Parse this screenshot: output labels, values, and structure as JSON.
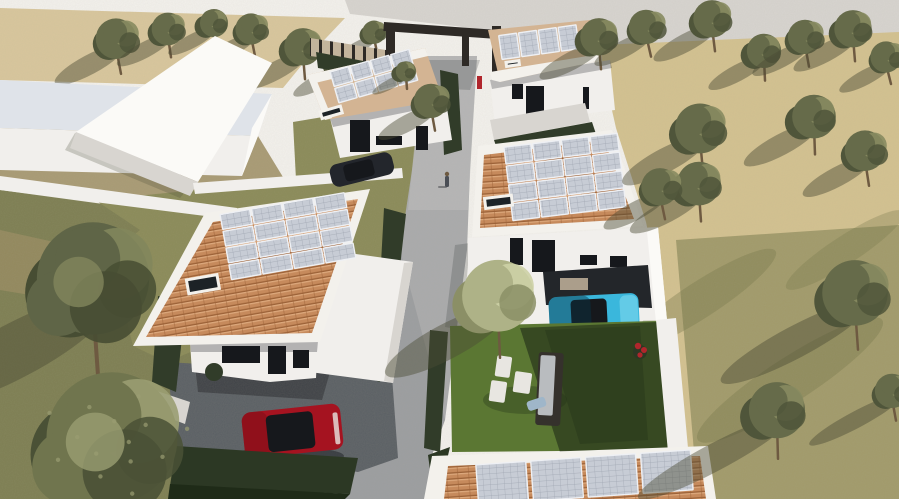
{
  "meta": {
    "description": "Aerial 3D architectural rendering of a residential development: five modern white houses with terracotta roofs and rooftop solar panels, a central grey footpath, an olive-tree orchard on the right, gardens with outdoor furniture, a red car on a driveway and a cyan car under a carport.",
    "render_type": "daylight exterior visualization, top-down oblique view"
  },
  "colors": {
    "sky_top": "#f3f1ed",
    "road_top": "#d7d4d0",
    "tan_ground": "#d8c69c",
    "tan_orchard": "#d3c190",
    "orchard_green": "#6f7444",
    "grass_left": "#7d7e52",
    "grass_mid": "#8a8a58",
    "grass_patch_brown": "#a08f66",
    "lawn_bright": "#5b7733",
    "lawn_shadow": "#1f2b18",
    "path": "#a9aaac",
    "path_light": "#bcbcbb",
    "path_dark": "#8e9094",
    "driveway": "#5a5f64",
    "shadow_dark": "#23262a",
    "soft_shadow": "#4c4c36",
    "wall_white": "#f1efec",
    "wall_bright": "#fbfaf7",
    "wall_shade": "#d8d5d0",
    "slab_top": "#dfe3e9",
    "fascia_white": "#f3f1ec",
    "tile_base": "#c68a5c",
    "tile_dark": "#9c6238",
    "tile_light": "#dca87c",
    "roof_tan": "#d3b493",
    "panel_fill": "#c7ccd5",
    "panel_line": "#9fa6b2",
    "panel_frame": "#eef0f4",
    "skylight_glass": "#1c2226",
    "hedge": "#313c29",
    "hedge_dark": "#2c3824",
    "dirt": "#a89a74",
    "trunk": "#6e5a41",
    "car_red": "#a51320",
    "car_red_dark": "#7c0e16",
    "car_glass": "#16181c",
    "car_cyan": "#3ab7dc",
    "car_cyan_light": "#7fd9ef",
    "car_cyan_shade": "#083445",
    "car_black": "#23262c",
    "furniture_frame": "#35312c",
    "furniture_cushion": "#b9bcbf",
    "furniture_white": "#e8e6e1",
    "towel_blue": "#9fb6c9",
    "flower_red": "#b0262c",
    "gate_wood": "#2e2a26",
    "fence_tan": "#c3b49c",
    "person": "#4a4e55",
    "trees": {
      "olive": {
        "base": "#666b4a",
        "dark": "#4f553a",
        "light": "#878b60"
      },
      "pale": {
        "base": "#aeb287",
        "dark": "#8b8f66",
        "light": "#cdd0a6"
      },
      "big": {
        "base": "#5f6547",
        "dark": "#474d33",
        "light": "#82865c"
      },
      "bush": {
        "base": "#70754e",
        "dark": "#4a5136",
        "light": "#9a9d72"
      }
    }
  },
  "scene": {
    "houses": [
      {
        "id": "neighbor-slab",
        "kind": "massing model",
        "roof": "flat white"
      },
      {
        "id": "neighbor-gable",
        "kind": "massing model",
        "roof": "white gable"
      },
      {
        "id": "house-a",
        "kind": "modern villa",
        "roof": "tan",
        "solar_panels": 8,
        "car": "dark"
      },
      {
        "id": "house-b",
        "kind": "modern villa",
        "roof": "tan",
        "solar_panels": 4
      },
      {
        "id": "house-c",
        "kind": "modern villa",
        "roof": "terracotta",
        "solar_panels": 16,
        "car": "cyan",
        "garden_furniture": true
      },
      {
        "id": "house-d",
        "kind": "modern villa",
        "roof": "terracotta",
        "solar_panels": 16,
        "car": "red"
      },
      {
        "id": "house-e",
        "kind": "modern villa (partially visible)",
        "roof": "terracotta",
        "solar_panels": 4
      }
    ],
    "cars": [
      {
        "color_key": "car_red",
        "location": "driveway of house-d"
      },
      {
        "color_key": "car_cyan",
        "location": "carport of house-c"
      },
      {
        "color_key": "car_black",
        "location": "front of house-a"
      }
    ],
    "people": [
      {
        "location": "footpath, upper middle"
      },
      {
        "location": "near entrance gate, red clothing"
      }
    ],
    "solar_arrays": [
      {
        "house": "house-d",
        "cx": 289,
        "cy": 237,
        "rot": -10,
        "x": 225,
        "y": 203,
        "cols": 4,
        "rows": 4,
        "cw": 30,
        "ch": 15,
        "gap": 2
      },
      {
        "house": "house-c",
        "cx": 565,
        "cy": 177,
        "rot": -7,
        "x": 508,
        "y": 140,
        "cols": 4,
        "rows": 4,
        "cw": 27,
        "ch": 17,
        "gap": 2
      },
      {
        "house": "house-a",
        "cx": 375,
        "cy": 80,
        "rot": -16,
        "x": 334,
        "y": 60,
        "cols": 4,
        "rows": 2,
        "cw": 19,
        "ch": 15,
        "gap": 2
      },
      {
        "house": "house-b",
        "cx": 540,
        "cy": 42,
        "rot": -8,
        "x": 500,
        "y": 30,
        "cols": 4,
        "rows": 1,
        "cw": 18,
        "ch": 24,
        "gap": 2
      },
      {
        "house": "house-e",
        "cx": 575,
        "cy": 478,
        "rot": -4,
        "x": 477,
        "y": 458,
        "cols": 4,
        "rows": 1,
        "cw": 50,
        "ch": 40,
        "gap": 5
      }
    ],
    "skylights": [
      {
        "x": 179,
        "y": 260,
        "w": 34,
        "h": 17,
        "cx": 289,
        "cy": 237,
        "rot": -10
      },
      {
        "x": 481,
        "y": 187,
        "w": 30,
        "h": 13,
        "cx": 565,
        "cy": 177,
        "rot": -7
      },
      {
        "x": 312,
        "y": 94,
        "w": 24,
        "h": 10,
        "cx": 375,
        "cy": 80,
        "rot": -16
      },
      {
        "x": 502,
        "y": 56,
        "w": 16,
        "h": 7,
        "cx": 540,
        "cy": 42,
        "rot": -8
      }
    ],
    "trees": [
      {
        "x": 118,
        "y": 40,
        "r": 26,
        "kind": "olive",
        "layer": "back"
      },
      {
        "x": 168,
        "y": 30,
        "r": 21,
        "kind": "olive",
        "layer": "back"
      },
      {
        "x": 212,
        "y": 24,
        "r": 18,
        "kind": "olive",
        "layer": "back"
      },
      {
        "x": 252,
        "y": 30,
        "r": 20,
        "kind": "olive",
        "layer": "back"
      },
      {
        "x": 302,
        "y": 48,
        "r": 24,
        "kind": "olive",
        "layer": "back"
      },
      {
        "x": 342,
        "y": 62,
        "r": 20,
        "kind": "olive",
        "layer": "back"
      },
      {
        "x": 374,
        "y": 33,
        "r": 15,
        "kind": "olive",
        "layer": "back"
      },
      {
        "x": 404,
        "y": 72,
        "r": 13,
        "kind": "olive",
        "layer": "front"
      },
      {
        "x": 432,
        "y": 102,
        "r": 22,
        "kind": "olive",
        "layer": "front"
      },
      {
        "x": 598,
        "y": 38,
        "r": 24,
        "kind": "olive",
        "layer": "front"
      },
      {
        "x": 648,
        "y": 28,
        "r": 22,
        "kind": "olive",
        "layer": "front"
      },
      {
        "x": 712,
        "y": 20,
        "r": 24,
        "kind": "olive",
        "layer": "front"
      },
      {
        "x": 762,
        "y": 52,
        "r": 22,
        "kind": "olive",
        "layer": "front"
      },
      {
        "x": 806,
        "y": 38,
        "r": 22,
        "kind": "olive",
        "layer": "front"
      },
      {
        "x": 852,
        "y": 30,
        "r": 24,
        "kind": "olive",
        "layer": "front"
      },
      {
        "x": 888,
        "y": 58,
        "r": 20,
        "kind": "olive",
        "layer": "front"
      },
      {
        "x": 700,
        "y": 130,
        "r": 32,
        "kind": "olive",
        "layer": "front"
      },
      {
        "x": 812,
        "y": 118,
        "r": 28,
        "kind": "olive",
        "layer": "front"
      },
      {
        "x": 866,
        "y": 152,
        "r": 26,
        "kind": "olive",
        "layer": "front"
      },
      {
        "x": 698,
        "y": 185,
        "r": 28,
        "kind": "olive",
        "layer": "front"
      },
      {
        "x": 662,
        "y": 188,
        "r": 24,
        "kind": "olive",
        "layer": "front"
      },
      {
        "x": 855,
        "y": 295,
        "r": 42,
        "kind": "olive",
        "layer": "front",
        "sl": 2.0
      },
      {
        "x": 775,
        "y": 412,
        "r": 36,
        "kind": "olive",
        "layer": "front",
        "sl": 2.4
      },
      {
        "x": 893,
        "y": 392,
        "r": 22,
        "kind": "olive",
        "layer": "front",
        "sl": 2.4
      },
      {
        "x": 497,
        "y": 298,
        "r": 46,
        "kind": "pale",
        "layer": "front"
      },
      {
        "x": 95,
        "y": 282,
        "r": 72,
        "kind": "big",
        "layer": "front"
      },
      {
        "x": 112,
        "y": 442,
        "r": 84,
        "kind": "bush",
        "layer": "front"
      }
    ]
  }
}
